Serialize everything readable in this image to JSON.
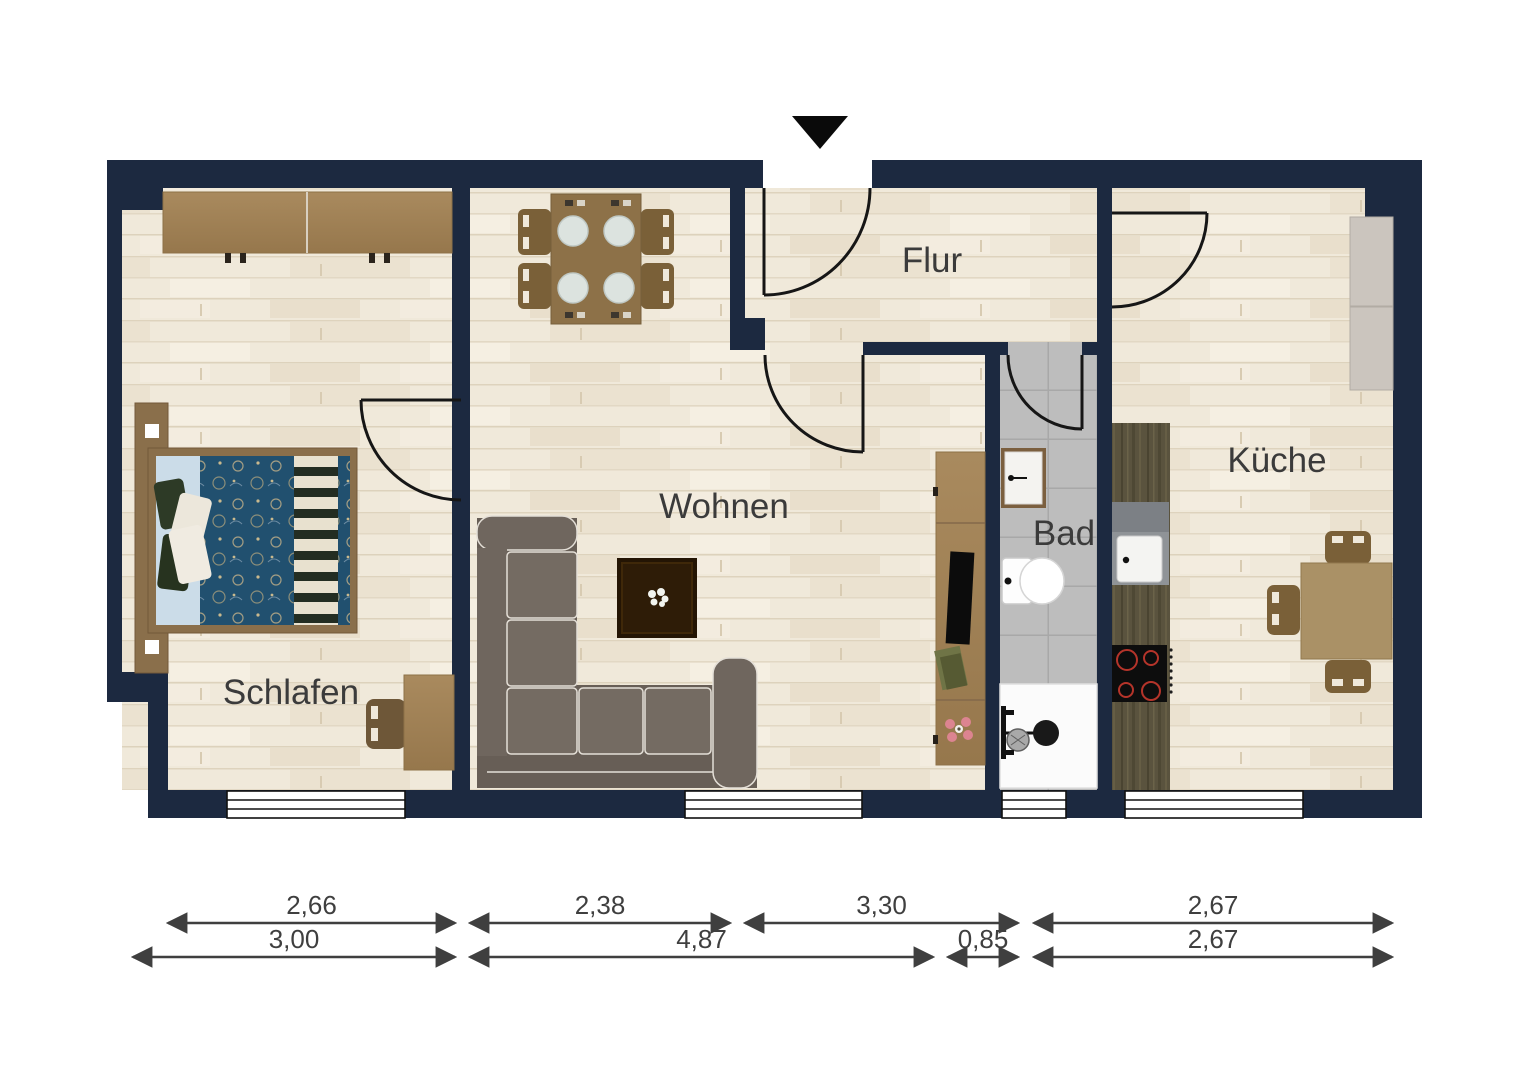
{
  "page": {
    "background": "#ffffff"
  },
  "plan": {
    "wall_color": "#1c2940",
    "floor_color": "#f0e9da",
    "bath_tile_color": "#bdbdbd",
    "door_line_color": "#161616",
    "entrance_arrow_color": "#0a0a0a",
    "room_labels": {
      "schlafen": "Schlafen",
      "wohnen": "Wohnen",
      "flur": "Flur",
      "bad": "Bad",
      "kueche": "Küche"
    },
    "furniture_icons": [
      "wardrobe-icon",
      "double-bed-icon",
      "desk-chair-icon",
      "dining-table-icon",
      "corner-sofa-icon",
      "coffee-table-icon",
      "tv-sideboard-icon",
      "bath-sink-icon",
      "toilet-icon",
      "shower-icon",
      "kitchen-counter-icon",
      "kitchen-sink-icon",
      "cooktop-icon",
      "tall-cabinet-icon",
      "kitchen-table-icon",
      "entrance-arrow-icon"
    ]
  },
  "dimensions": {
    "line_color": "#3f3f3f",
    "rows": [
      {
        "y": 923,
        "segments": [
          {
            "x1": 168,
            "x2": 455,
            "label": "2,66"
          },
          {
            "x1": 470,
            "x2": 730,
            "label": "2,38"
          },
          {
            "x1": 745,
            "x2": 1018,
            "label": "3,30"
          },
          {
            "x1": 1034,
            "x2": 1392,
            "label": "2,67"
          }
        ]
      },
      {
        "y": 957,
        "segments": [
          {
            "x1": 133,
            "x2": 455,
            "label": "3,00"
          },
          {
            "x1": 470,
            "x2": 933,
            "label": "4,87"
          },
          {
            "x1": 948,
            "x2": 1018,
            "label": "0,85"
          },
          {
            "x1": 1034,
            "x2": 1392,
            "label": "2,67"
          }
        ]
      }
    ]
  }
}
